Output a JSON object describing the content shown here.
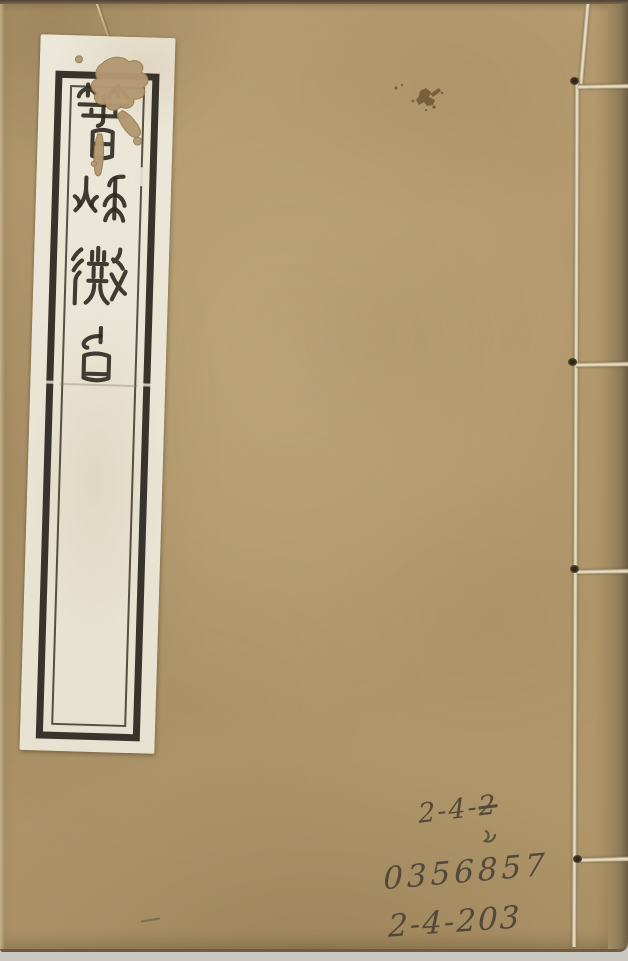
{
  "book": {
    "title_label": {
      "text": "春秋微旨",
      "script": "seal script",
      "characters": [
        "春",
        "秋",
        "微",
        "旨"
      ]
    },
    "handwriting": {
      "shelfmark_top_prefix": "2-4-",
      "shelfmark_top_struck_digit": "2",
      "accession_number": "0356857",
      "shelfmark_bottom": "2-4-203"
    },
    "binding": {
      "stitch_holes": "4"
    },
    "colors": {
      "cover": "#b49b6f",
      "label_paper": "#ece7d9",
      "border_ink": "#29241d",
      "thread": "#e6ddc5",
      "handwriting_ink": "#4b4237",
      "backdrop": "#cbc8c2"
    }
  }
}
